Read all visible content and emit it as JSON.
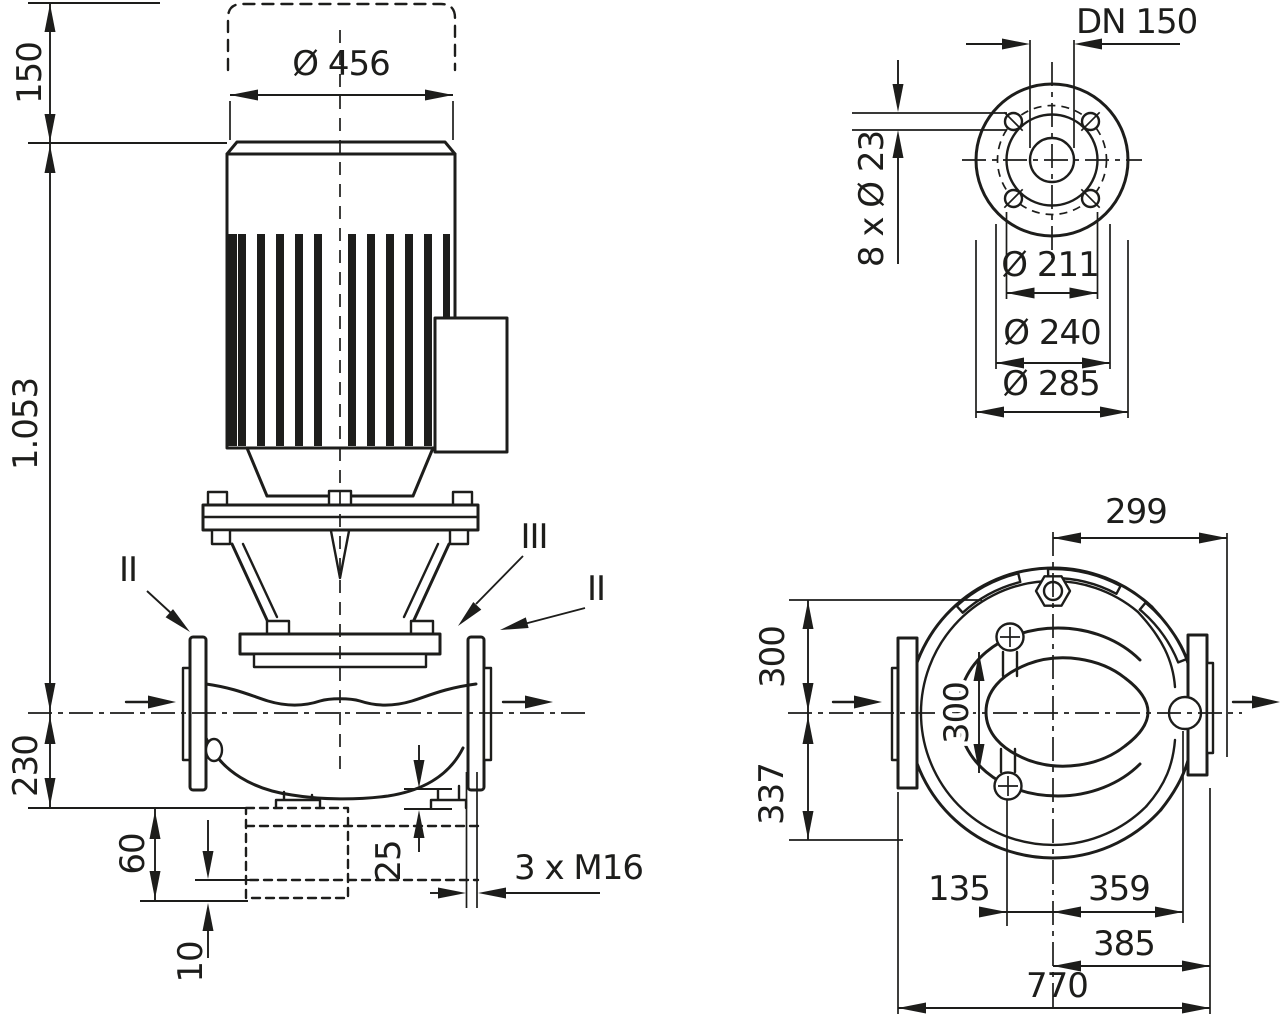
{
  "drawing": {
    "kind": "pump-dimensional-technical-drawing",
    "background_color": "#ffffff",
    "line_color": "#1d1d1b",
    "views": [
      "front-elevation",
      "flange-detail",
      "plan-top-view"
    ]
  },
  "front_view": {
    "dim_motor_top_clearance": "150",
    "dim_total_height": "1.053",
    "dim_motor_diameter": "Ø 456",
    "dim_center_to_base": "230",
    "dim_foundation_height": "60",
    "dim_shim_height": "10",
    "dim_drain_offset": "25",
    "dim_drain_thread": "3 x M16",
    "label_section_left": "II",
    "label_section_mid": "III",
    "label_section_right": "II"
  },
  "flange_view": {
    "dim_nominal_bore": "DN 150",
    "dim_bolt_holes": "8 x Ø 23",
    "dim_raised_face": "Ø 211",
    "dim_bolt_circle": "Ø 240",
    "dim_outer_diameter": "Ø 285"
  },
  "plan_view": {
    "dim_center_to_right_edge": "299",
    "dim_center_to_top": "300",
    "dim_center_to_bottom": "337",
    "dim_port_spacing": "300",
    "dim_port_offset": "135",
    "dim_center_to_port": "359",
    "dim_center_to_flange": "385",
    "dim_total_width": "770"
  }
}
